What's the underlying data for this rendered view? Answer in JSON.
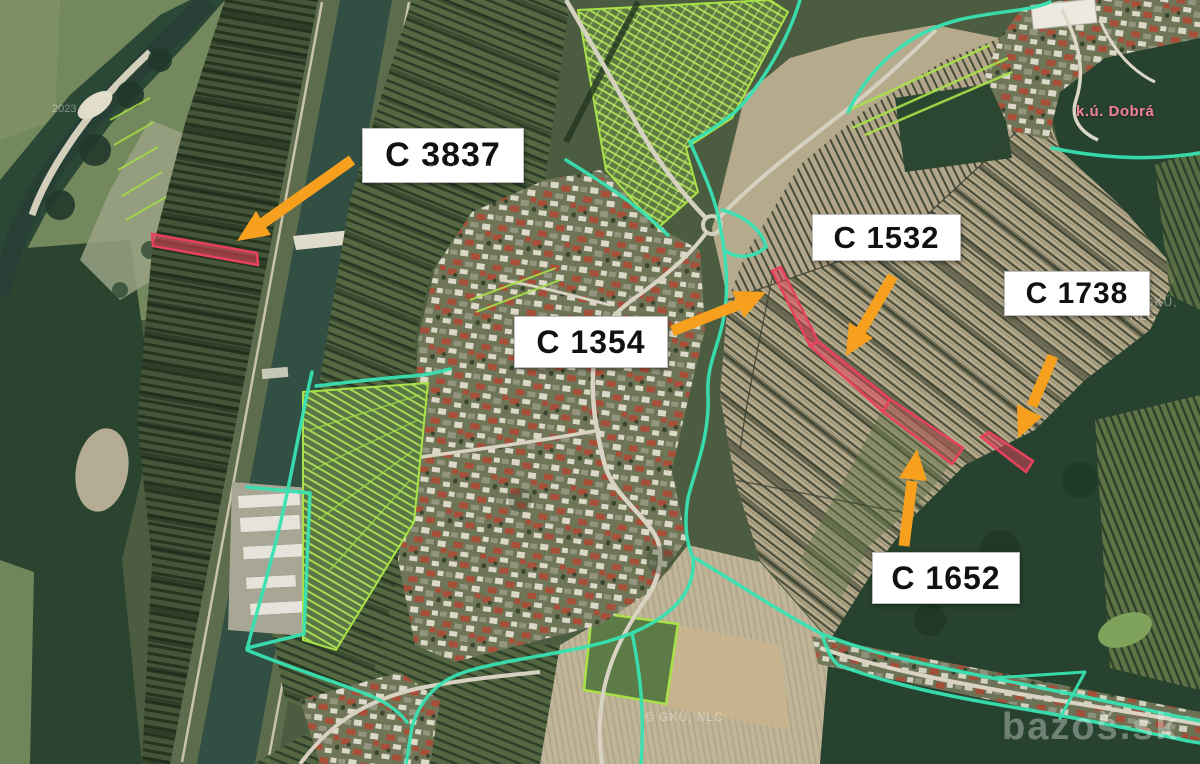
{
  "map": {
    "region_label": "k.ú. Dobrá",
    "ortho_credit": "© GKÚ, NLC",
    "year_mark": "2023",
    "site_watermark": "bazoš.sk",
    "parcels": [
      {
        "id": "C 3837"
      },
      {
        "id": "C 1354"
      },
      {
        "id": "C 1532"
      },
      {
        "id": "C 1738"
      },
      {
        "id": "C 1652"
      }
    ]
  },
  "colors": {
    "arrow": "#F6A01E",
    "parcel_red": "#E8415C",
    "boundary_teal": "#38E2B2",
    "parcel_lime": "#A8E248",
    "label_bg": "#FFFFFF",
    "label_text": "#111111",
    "region_pink": "#F2839D"
  }
}
